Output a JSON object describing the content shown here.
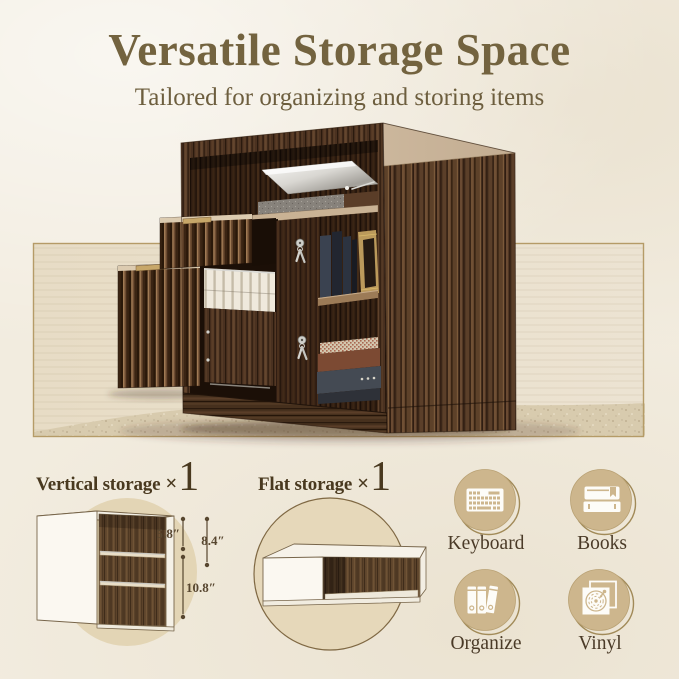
{
  "header": {
    "title": "Versatile Storage Space",
    "subtitle": "Tailored for organizing and storing items"
  },
  "storage_options": [
    {
      "label": "Vertical storage",
      "times": "×",
      "count": "1"
    },
    {
      "label": "Flat storage",
      "times": "×",
      "count": "1"
    }
  ],
  "dimensions": {
    "upper_shelf": "5.8″",
    "side_total": "8.4″",
    "lower_shelf": "10.8″"
  },
  "features": [
    {
      "label": "Keyboard",
      "icon": "keyboard-icon"
    },
    {
      "label": "Books",
      "icon": "books-icon"
    },
    {
      "label": "Organize",
      "icon": "binders-icon"
    },
    {
      "label": "Vinyl",
      "icon": "vinyl-icon"
    }
  ],
  "colors": {
    "background": "#f2ecdf",
    "title_text": "#73633f",
    "label_text": "#4a3a27",
    "band_border": "#b59b67",
    "band_fill": "#e9dfcb",
    "sand": "#d7c9ac",
    "wood_dark": "#4e3522",
    "wood_light": "#cdb79c",
    "circle_tan": "#cdb68d",
    "icon_glyph": "#fdfcf8"
  }
}
